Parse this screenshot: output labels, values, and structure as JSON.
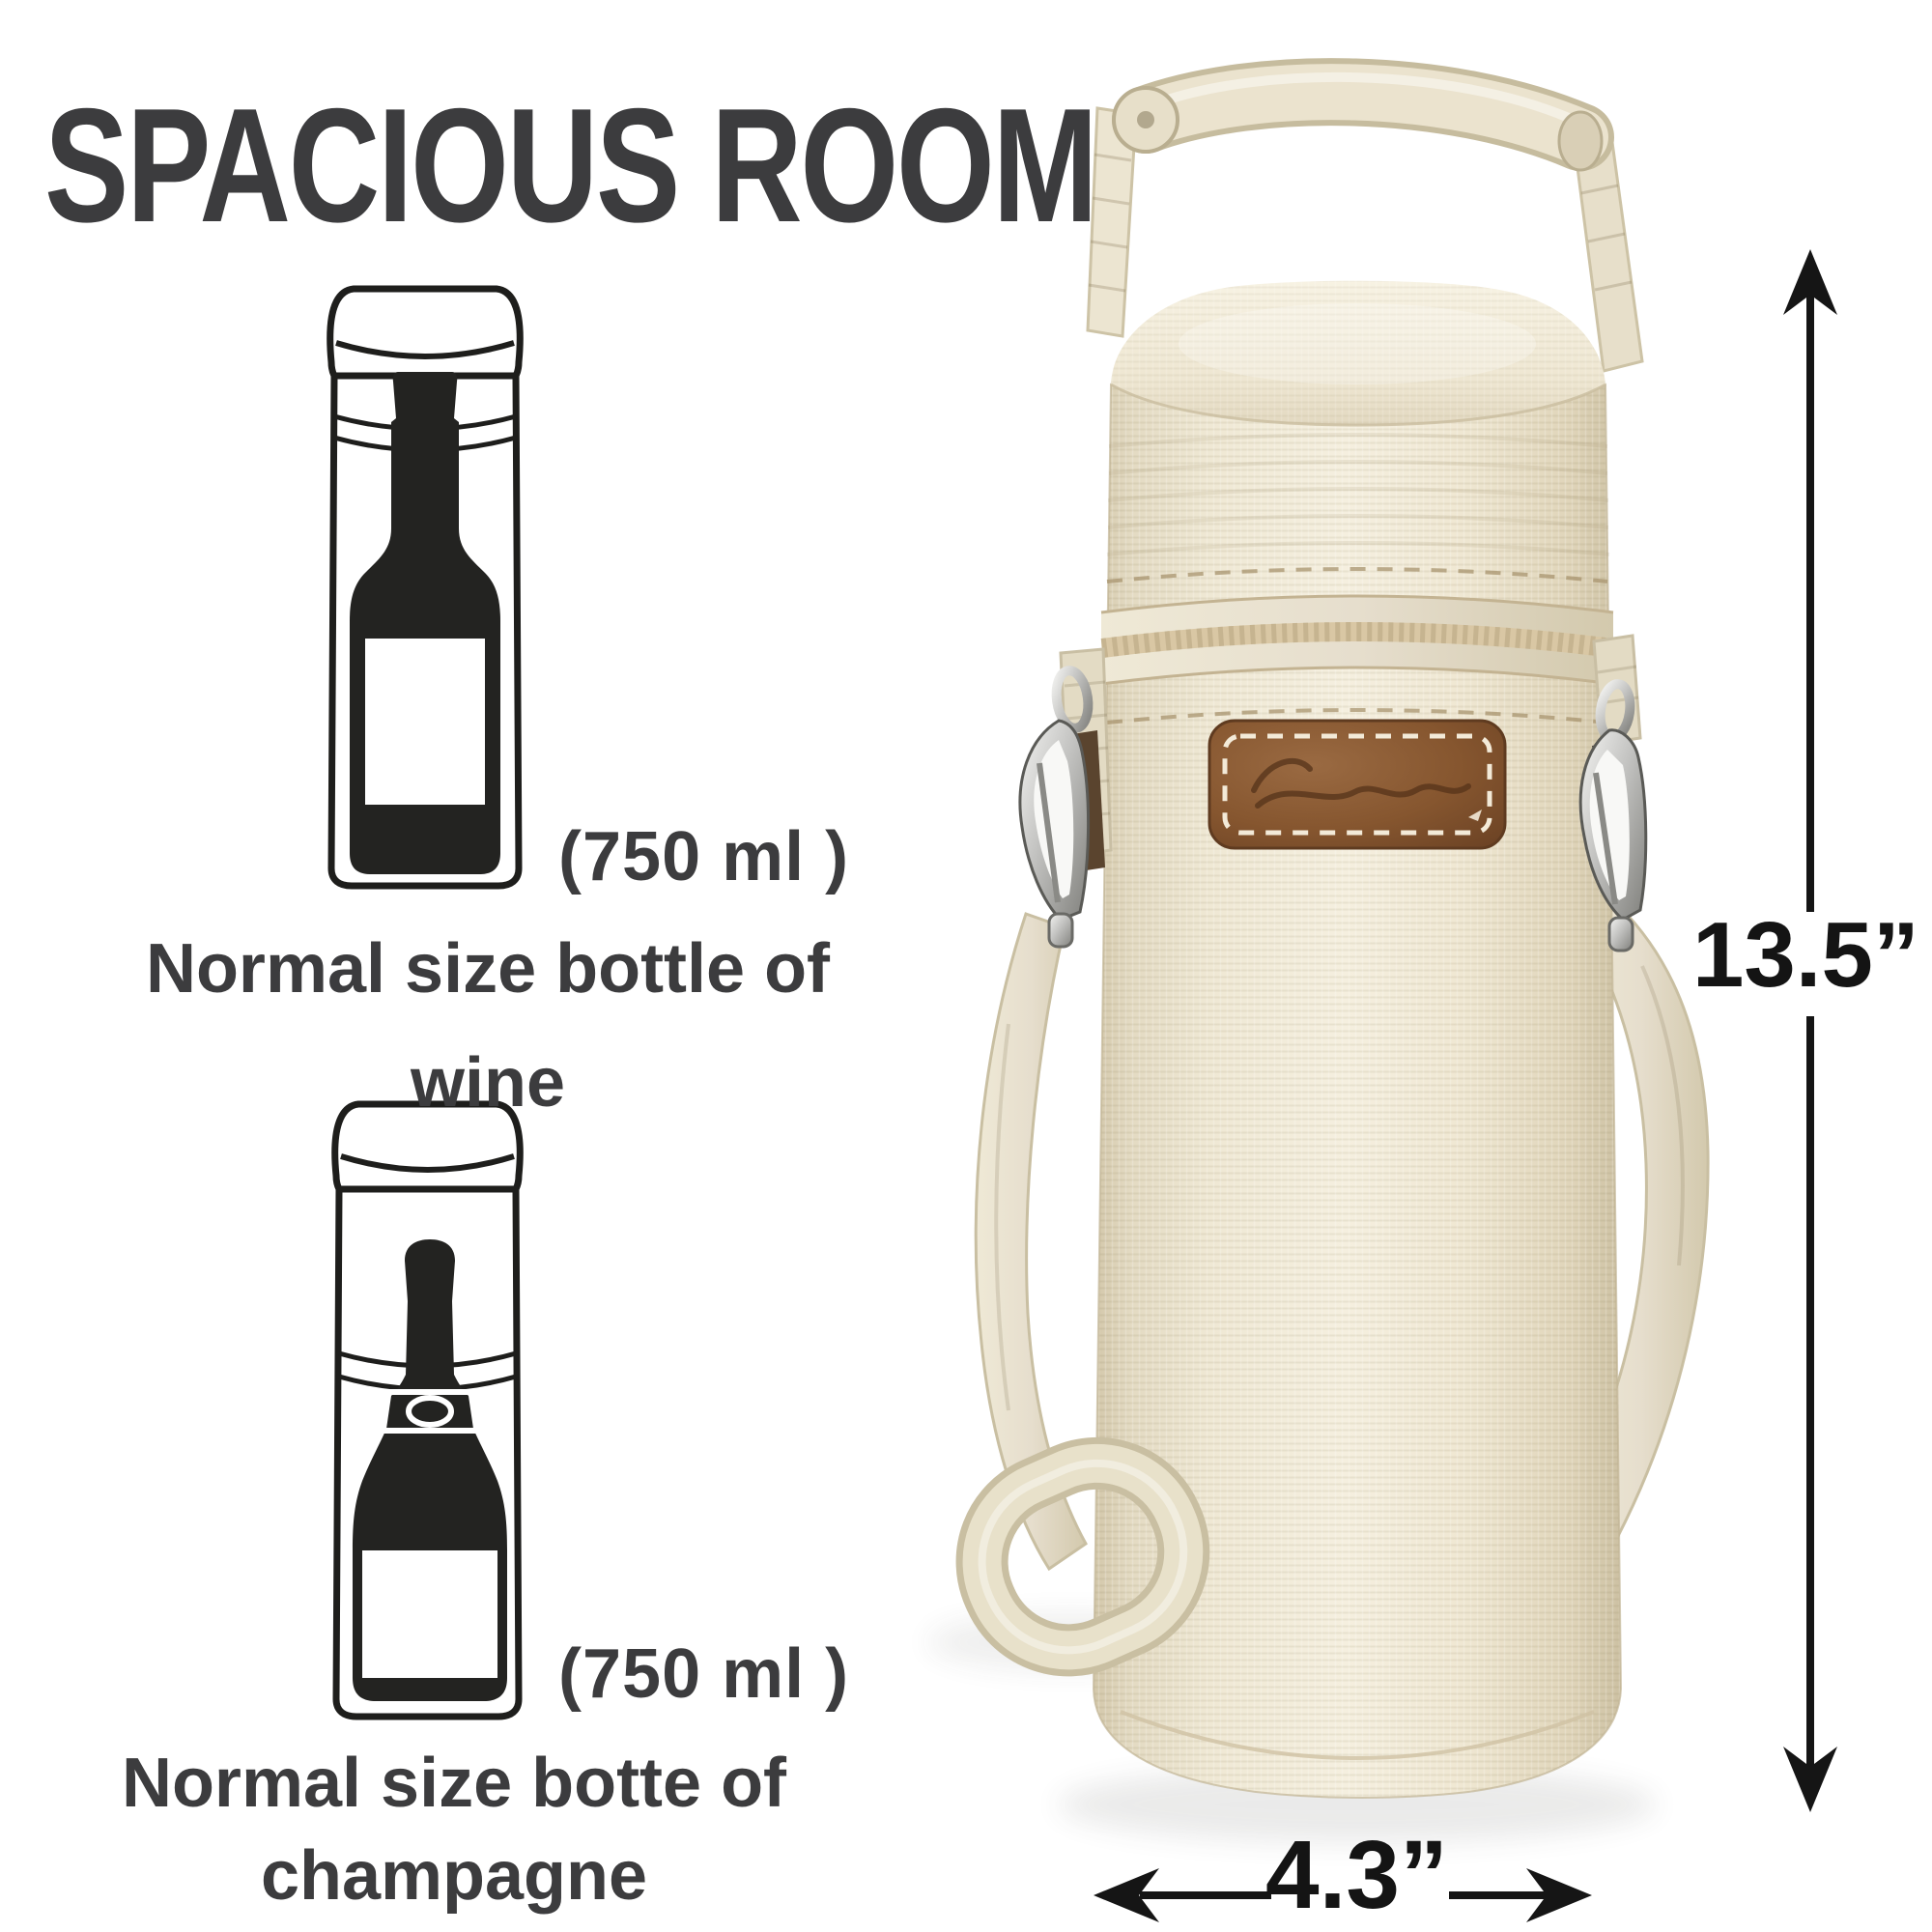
{
  "title": "SPACIOUS ROOM",
  "wine": {
    "volume": "(750 ml )",
    "line1": "Normal size bottle of",
    "line2": "wine"
  },
  "champagne": {
    "volume": "(750 ml )",
    "line1": "Normal size botte of",
    "line2": "champagne"
  },
  "dimensions": {
    "height": "13.5”",
    "width": "4.3”"
  },
  "icons": {
    "wine_bottle": "wine-bottle-in-case-illustration",
    "champagne_bottle": "champagne-bottle-in-case-illustration",
    "snap_hook": "metal-carabiner-snap-hook",
    "arrows": "double-headed-dimension-arrows"
  },
  "colors": {
    "ink": "#3c3c3e",
    "annotation": "#141414",
    "canvas": "#efe8d4",
    "canvas_shadow": "#d6cbaf",
    "strap": "#e7dfc8",
    "zipper_tape": "#d8c9ab",
    "leather_patch": "#83552f",
    "metal_clip": "#b4b4b2",
    "line_art": "#1e1e1c"
  }
}
